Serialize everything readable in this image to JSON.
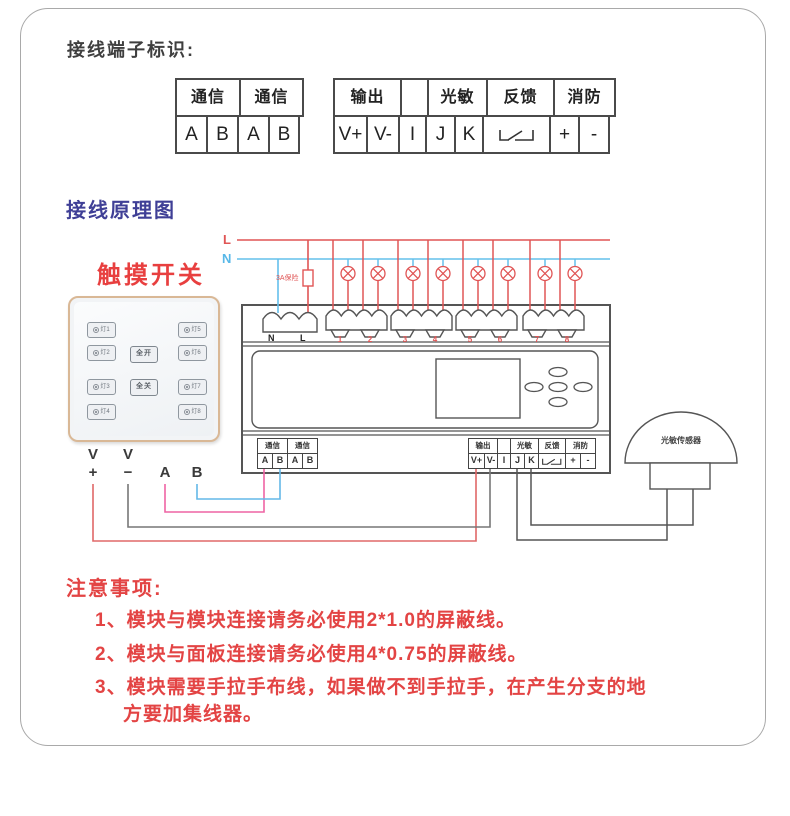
{
  "headings": {
    "terminal_id": "接线端子标识:",
    "wiring_diagram": "接线原理图",
    "touch_switch": "触摸开关"
  },
  "legend": {
    "comm": {
      "headers": [
        "通信",
        "通信"
      ],
      "cells": [
        "A",
        "B",
        "A",
        "B"
      ]
    },
    "io": {
      "headers": [
        "输出",
        "光敏",
        "反馈",
        "消防"
      ],
      "cells": [
        "V+",
        "V-",
        "I",
        "J",
        "K",
        "+",
        "-"
      ],
      "feedback_switch_icon": "relay-contact-icon"
    }
  },
  "panel": {
    "buttons": [
      "灯1",
      "灯2",
      "灯3",
      "灯4",
      "灯5",
      "灯6",
      "灯7",
      "灯8"
    ],
    "all_on": "全开",
    "all_off": "全关",
    "wire_labels": [
      "V",
      "+",
      "V",
      "−",
      "A",
      "B"
    ]
  },
  "module": {
    "power": {
      "l": "L",
      "n": "N"
    },
    "fuse": "3A保险",
    "terms": {
      "n": "N",
      "l": "L"
    },
    "channels": [
      "1",
      "2",
      "3",
      "4",
      "5",
      "6",
      "7",
      "8"
    ],
    "comm": {
      "headers": [
        "通信",
        "通信"
      ],
      "cells": [
        "A",
        "B",
        "A",
        "B"
      ]
    },
    "io": {
      "headers": [
        "输出",
        "光敏",
        "反馈",
        "消防"
      ],
      "cells": [
        "V+",
        "V-",
        "I",
        "J",
        "K",
        "+",
        "-"
      ]
    }
  },
  "sensor": {
    "label": "光敏传感器"
  },
  "notes": {
    "title": "注意事项:",
    "lines": [
      "1、模块与模块连接请务必使用2*1.0的屏蔽线。",
      "2、模块与面板连接请务必使用4*0.75的屏蔽线。",
      "3、模块需要手拉手布线，如果做不到手拉手，在产生分支的地",
      "方要加集线器。"
    ]
  },
  "colors": {
    "accent_red": "#e34444",
    "heading_blue": "#3f3f96",
    "live_line": "#e05555",
    "neutral_line": "#64c0ec",
    "comm_a_wire": "#ee64a4",
    "comm_b_wire": "#64b8e8",
    "panel_frame": "#d9b896"
  }
}
